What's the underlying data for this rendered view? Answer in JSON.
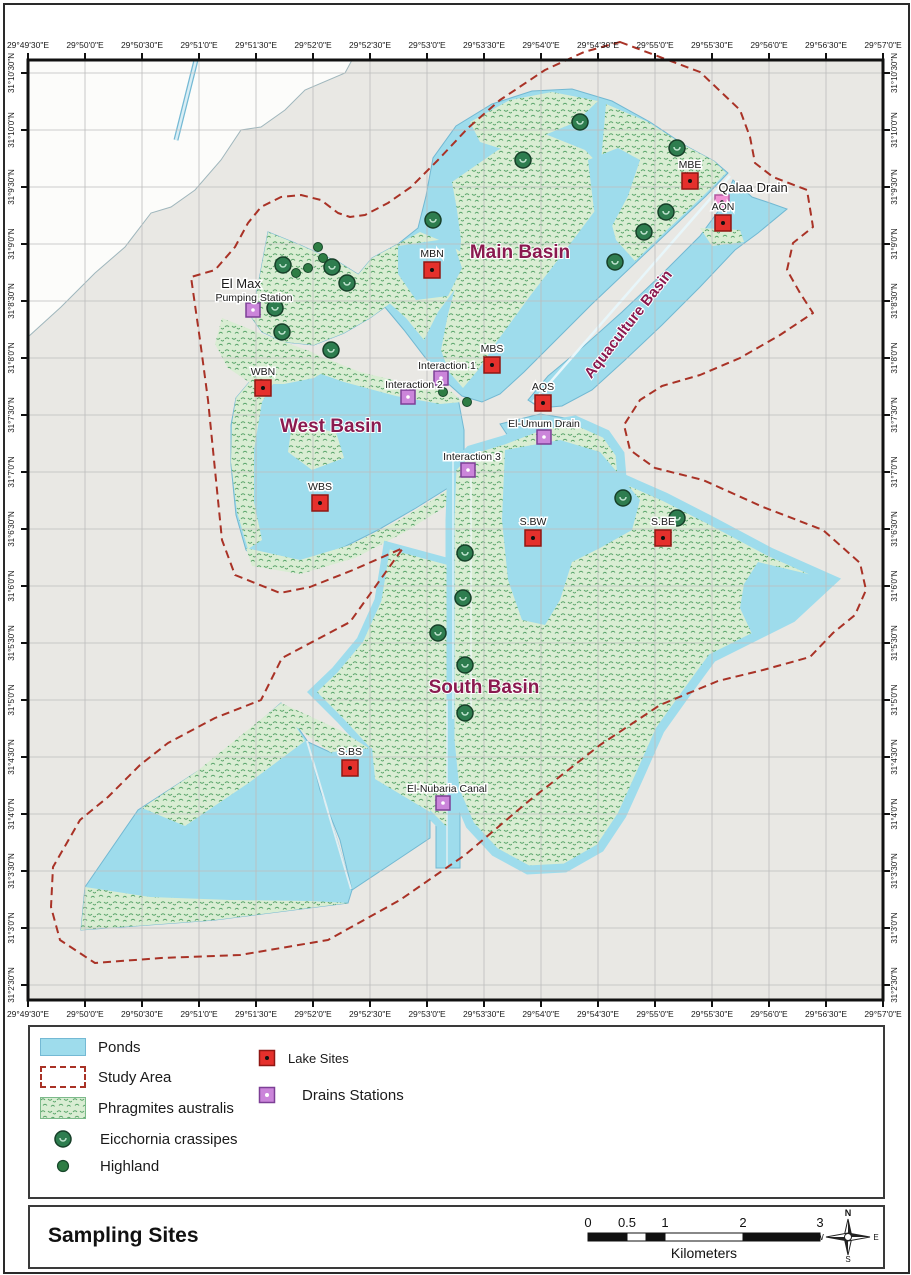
{
  "map": {
    "axis": {
      "lon": [
        "29°49'30\"E",
        "29°50'0\"E",
        "29°50'30\"E",
        "29°51'0\"E",
        "29°51'30\"E",
        "29°52'0\"E",
        "29°52'30\"E",
        "29°53'0\"E",
        "29°53'30\"E",
        "29°54'0\"E",
        "29°54'30\"E",
        "29°55'0\"E",
        "29°55'30\"E",
        "29°56'0\"E",
        "29°56'30\"E",
        "29°57'0\"E"
      ],
      "lat": [
        "31°10'30\"N",
        "31°10'0\"N",
        "31°9'30\"N",
        "31°9'0\"N",
        "31°8'30\"N",
        "31°8'0\"N",
        "31°7'30\"N",
        "31°7'0\"N",
        "31°6'30\"N",
        "31°6'0\"N",
        "31°5'30\"N",
        "31°5'0\"N",
        "31°4'30\"N",
        "31°4'0\"N",
        "31°3'30\"N",
        "31°3'0\"N",
        "31°2'30\"N"
      ]
    },
    "basins": [
      {
        "label": "Main Basin",
        "x": 520,
        "y": 258,
        "size": 19,
        "rotate": 0
      },
      {
        "label": "West Basin",
        "x": 331,
        "y": 432,
        "size": 19,
        "rotate": 0
      },
      {
        "label": "South Basin",
        "x": 484,
        "y": 693,
        "size": 19,
        "rotate": 0
      },
      {
        "label": "Aquaculture Basin",
        "x": 632,
        "y": 327,
        "size": 15,
        "rotate": -52
      }
    ],
    "lake_sites": [
      {
        "label": "MBE",
        "x": 690,
        "y": 181
      },
      {
        "label": "AQN",
        "x": 723,
        "y": 223
      },
      {
        "label": "MBN",
        "x": 432,
        "y": 270
      },
      {
        "label": "MBS",
        "x": 492,
        "y": 365
      },
      {
        "label": "AQS",
        "x": 543,
        "y": 403
      },
      {
        "label": "WBN",
        "x": 263,
        "y": 388
      },
      {
        "label": "WBS",
        "x": 320,
        "y": 503
      },
      {
        "label": "S.BW",
        "x": 533,
        "y": 538
      },
      {
        "label": "S.BE",
        "x": 663,
        "y": 538
      },
      {
        "label": "S.BS",
        "x": 350,
        "y": 768
      }
    ],
    "drain_stations": [
      {
        "label": "Qalaa Drain",
        "x": 722,
        "y": 202,
        "variant": "pink",
        "label_size": 13,
        "label_x": 753,
        "label_y": 192
      },
      {
        "label": "El Max",
        "label2": "Pumping Station",
        "x": 253,
        "y": 310,
        "label_size": 13,
        "label_x": 241,
        "label_y": 288,
        "label2_x": 254,
        "label2_y": 301
      },
      {
        "label": "Interaction 1",
        "x": 441,
        "y": 378,
        "label_x": 447,
        "label_y": 369
      },
      {
        "label": "Interaction 2",
        "x": 408,
        "y": 397,
        "label_x": 414,
        "label_y": 388
      },
      {
        "label": "Interaction 3",
        "x": 468,
        "y": 470,
        "label_x": 472,
        "label_y": 460
      },
      {
        "label": "El-Umum Drain",
        "x": 544,
        "y": 437,
        "label_x": 544,
        "label_y": 427
      },
      {
        "label": "El-Nubaria Canal",
        "x": 443,
        "y": 803,
        "label_x": 447,
        "label_y": 792
      }
    ],
    "eicchornia": [
      [
        580,
        122
      ],
      [
        523,
        160
      ],
      [
        677,
        148
      ],
      [
        666,
        212
      ],
      [
        644,
        232
      ],
      [
        615,
        262
      ],
      [
        433,
        220
      ],
      [
        283,
        265
      ],
      [
        332,
        267
      ],
      [
        347,
        283
      ],
      [
        282,
        332
      ],
      [
        331,
        350
      ],
      [
        275,
        308
      ],
      [
        623,
        498
      ],
      [
        677,
        518
      ],
      [
        465,
        553
      ],
      [
        463,
        598
      ],
      [
        438,
        633
      ],
      [
        465,
        665
      ],
      [
        465,
        713
      ]
    ],
    "highland": [
      [
        318,
        247
      ],
      [
        323,
        258
      ],
      [
        308,
        268
      ],
      [
        296,
        273
      ],
      [
        443,
        392
      ],
      [
        467,
        402
      ]
    ],
    "colors": {
      "water": "#9edcec",
      "land": "#e9e8e4",
      "vegetation": "#d9edd3",
      "study_area": "#a93226",
      "lake_site": "#e5302c",
      "drain_station": "#cb85da",
      "qalaa_drain": "#f092d4",
      "basin_label": "#8a1a4f"
    }
  },
  "legend": {
    "items_left": [
      {
        "key": "ponds",
        "label": "Ponds"
      },
      {
        "key": "study-area",
        "label": "Study Area"
      },
      {
        "key": "phragmites",
        "label": "Phragmites australis"
      },
      {
        "key": "eicchornia",
        "label": "Eicchornia crassipes"
      },
      {
        "key": "highland",
        "label": "Highland"
      }
    ],
    "items_right": [
      {
        "key": "lake-sites",
        "label": "Lake Sites"
      },
      {
        "key": "drains-stations",
        "label": "Drains Stations"
      }
    ]
  },
  "footer": {
    "title": "Sampling Sites",
    "scale_ticks": [
      "0",
      "0.5",
      "1",
      "2",
      "3"
    ],
    "scale_unit": "Kilometers",
    "compass": {
      "n": "N",
      "w": "W",
      "e": "E",
      "s": "S"
    }
  }
}
